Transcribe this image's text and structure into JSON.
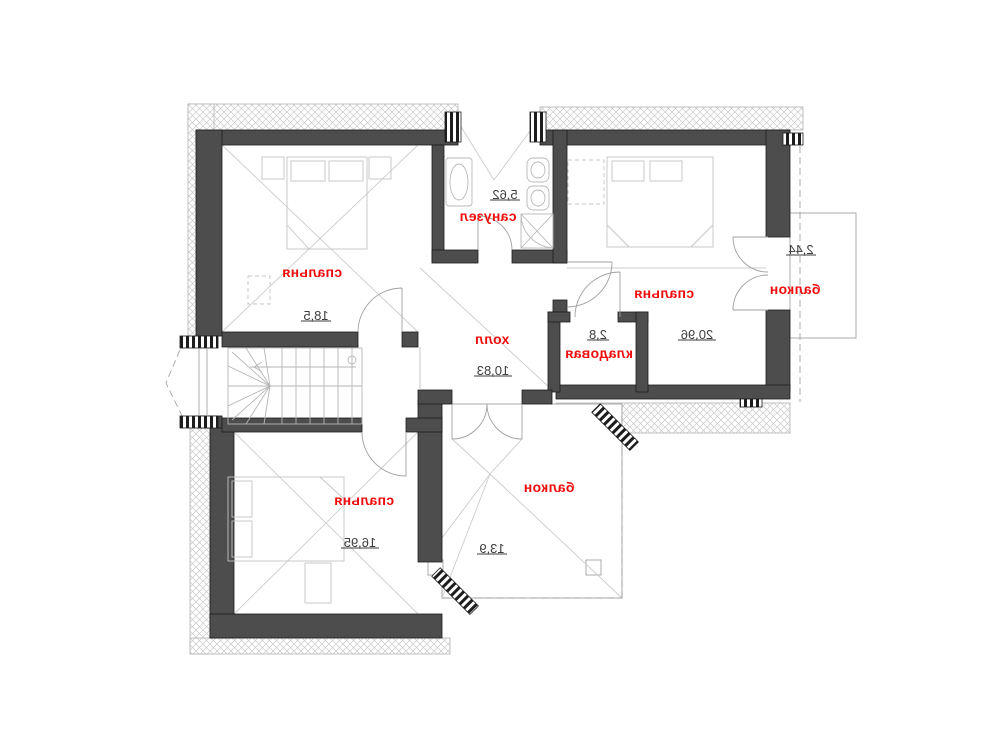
{
  "plan": {
    "title": "attic-floor-plan",
    "rooms": [
      {
        "name": "bedroom-top-left",
        "label": "спальня",
        "area": "18,5"
      },
      {
        "name": "bathroom",
        "label": "санузел",
        "area": "5,62"
      },
      {
        "name": "bedroom-top-right",
        "label": "спальня",
        "area": "20,96"
      },
      {
        "name": "balcony-right",
        "label": "балкон",
        "area": "2,44"
      },
      {
        "name": "storage",
        "label": "кладовая",
        "area": "2,8"
      },
      {
        "name": "hall",
        "label": "холл",
        "area": "10,83"
      },
      {
        "name": "bedroom-bottom-left",
        "label": "спальня",
        "area": "16,95"
      },
      {
        "name": "balcony-bottom",
        "label": "балкон",
        "area": "13,9"
      }
    ],
    "colors": {
      "room_label": "#ee0c0c",
      "room_area": "#3d3d3d",
      "wall": "#4d4d4d"
    }
  }
}
